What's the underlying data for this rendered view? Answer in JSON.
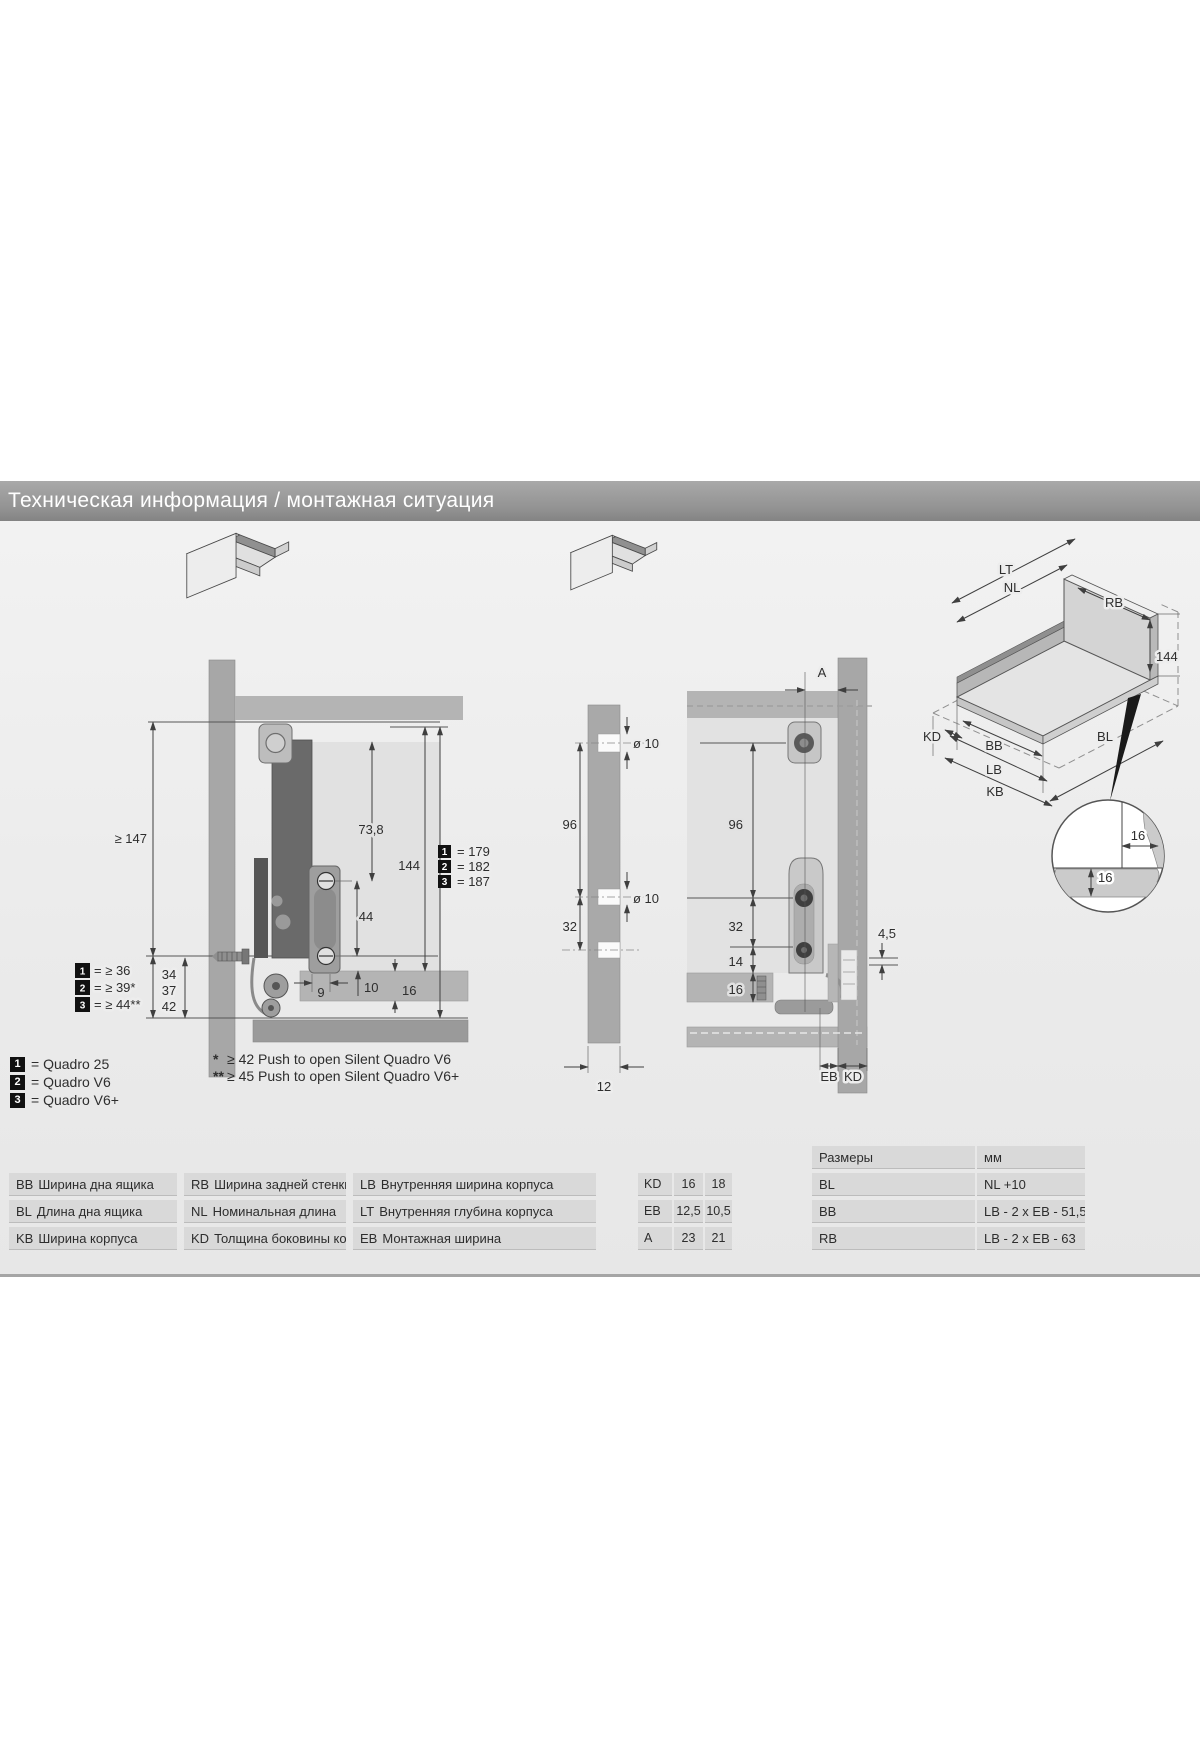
{
  "title": "Техническая информация / монтажная ситуация",
  "colors": {
    "title_bar": "#929292",
    "content_bg": "#ededed",
    "cell_bg": "#d9d9d9",
    "profile_dark": "#6a6a6a"
  },
  "left_drawing": {
    "dim_min_height": "≥ 147",
    "dim_73_8": "73,8",
    "dim_144": "144",
    "dim_44": "44",
    "dim_9": "9",
    "dim_10": "10",
    "dim_16": "16",
    "min_rows": [
      {
        "num": "1",
        "label": "= ≥ 36",
        "value": "34"
      },
      {
        "num": "2",
        "label": "= ≥ 39*",
        "value": "37"
      },
      {
        "num": "3",
        "label": "= ≥ 44**",
        "value": "42"
      }
    ],
    "total_rows": [
      {
        "num": "1",
        "label": "= 179"
      },
      {
        "num": "2",
        "label": "= 182"
      },
      {
        "num": "3",
        "label": "= 187"
      }
    ]
  },
  "middle_drawing": {
    "dim_96": "96",
    "dim_32": "32",
    "dim_hole_top": "ø 10",
    "dim_hole_mid": "ø 10",
    "dim_12": "12"
  },
  "right_drawing": {
    "dim_a": "A",
    "dim_96": "96",
    "dim_32": "32",
    "dim_14": "14",
    "dim_16": "16",
    "dim_4_5": "4,5",
    "label_eb": "EB",
    "label_kd": "KD"
  },
  "iso_drawing": {
    "lt": "LT",
    "nl": "NL",
    "rb": "RB",
    "dim_144": "144",
    "kd": "KD",
    "bb": "BB",
    "lb": "LB",
    "kb": "KB",
    "bl": "BL",
    "detail_16_h": "16",
    "detail_16_v": "16"
  },
  "product_legend": [
    {
      "num": "1",
      "label": "= Quadro 25"
    },
    {
      "num": "2",
      "label": "= Quadro V6"
    },
    {
      "num": "3",
      "label": "= Quadro V6+"
    }
  ],
  "footnotes": [
    {
      "marker": "*",
      "text": "≥ 42 Push to open Silent Quadro V6"
    },
    {
      "marker": "**",
      "text": "≥ 45 Push to open Silent Quadro V6+"
    }
  ],
  "glossary": {
    "rows": [
      [
        {
          "code": "BB",
          "text": "Ширина дна ящика"
        },
        {
          "code": "RB",
          "text": "Ширина задней стенки"
        },
        {
          "code": "LB",
          "text": "Внутренняя ширина корпуса"
        }
      ],
      [
        {
          "code": "BL",
          "text": "Длина дна ящика"
        },
        {
          "code": "NL",
          "text": "Номинальная длина"
        },
        {
          "code": "LT",
          "text": "Внутренняя глубина корпуса"
        }
      ],
      [
        {
          "code": "KB",
          "text": "Ширина корпуса"
        },
        {
          "code": "KD",
          "text": "Толщина боковины корпуса"
        },
        {
          "code": "EB",
          "text": "Монтажная ширина"
        }
      ]
    ]
  },
  "values_table": {
    "rows": [
      [
        "KD",
        "16",
        "18"
      ],
      [
        "EB",
        "12,5",
        "10,5"
      ],
      [
        "A",
        "23",
        "21"
      ]
    ]
  },
  "dims_table": {
    "header": [
      "Размеры",
      "мм"
    ],
    "rows": [
      [
        "BL",
        "NL +10"
      ],
      [
        "BB",
        "LB - 2 x EB - 51,5"
      ],
      [
        "RB",
        "LB - 2 x EB - 63"
      ]
    ]
  }
}
